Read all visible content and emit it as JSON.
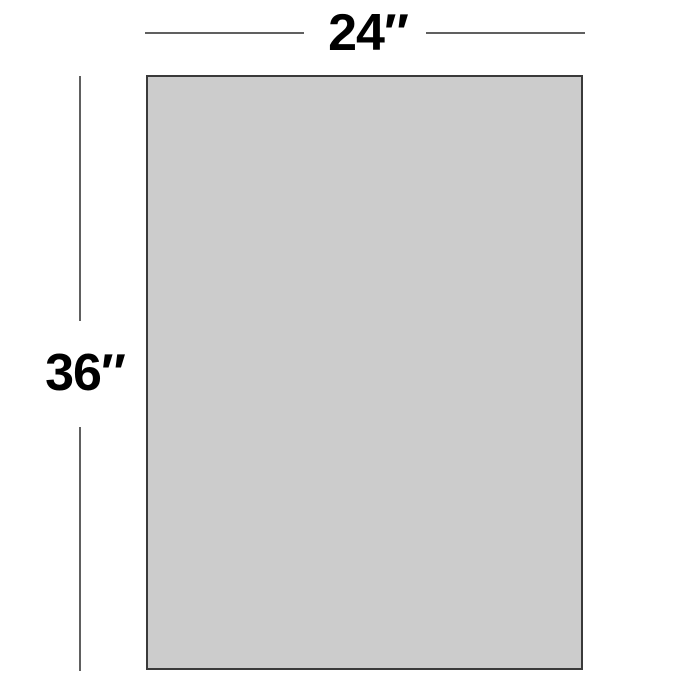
{
  "diagram": {
    "title": "rectangle-dimension-diagram",
    "width_label": "24″",
    "height_label": "36″",
    "width_value_inches": 24,
    "height_value_inches": 36
  },
  "colors": {
    "background": "#ffffff",
    "rect_fill": "#cccccc",
    "rect_border": "#3a3a3a",
    "dim_line": "#606060",
    "label_color": "#000000"
  }
}
